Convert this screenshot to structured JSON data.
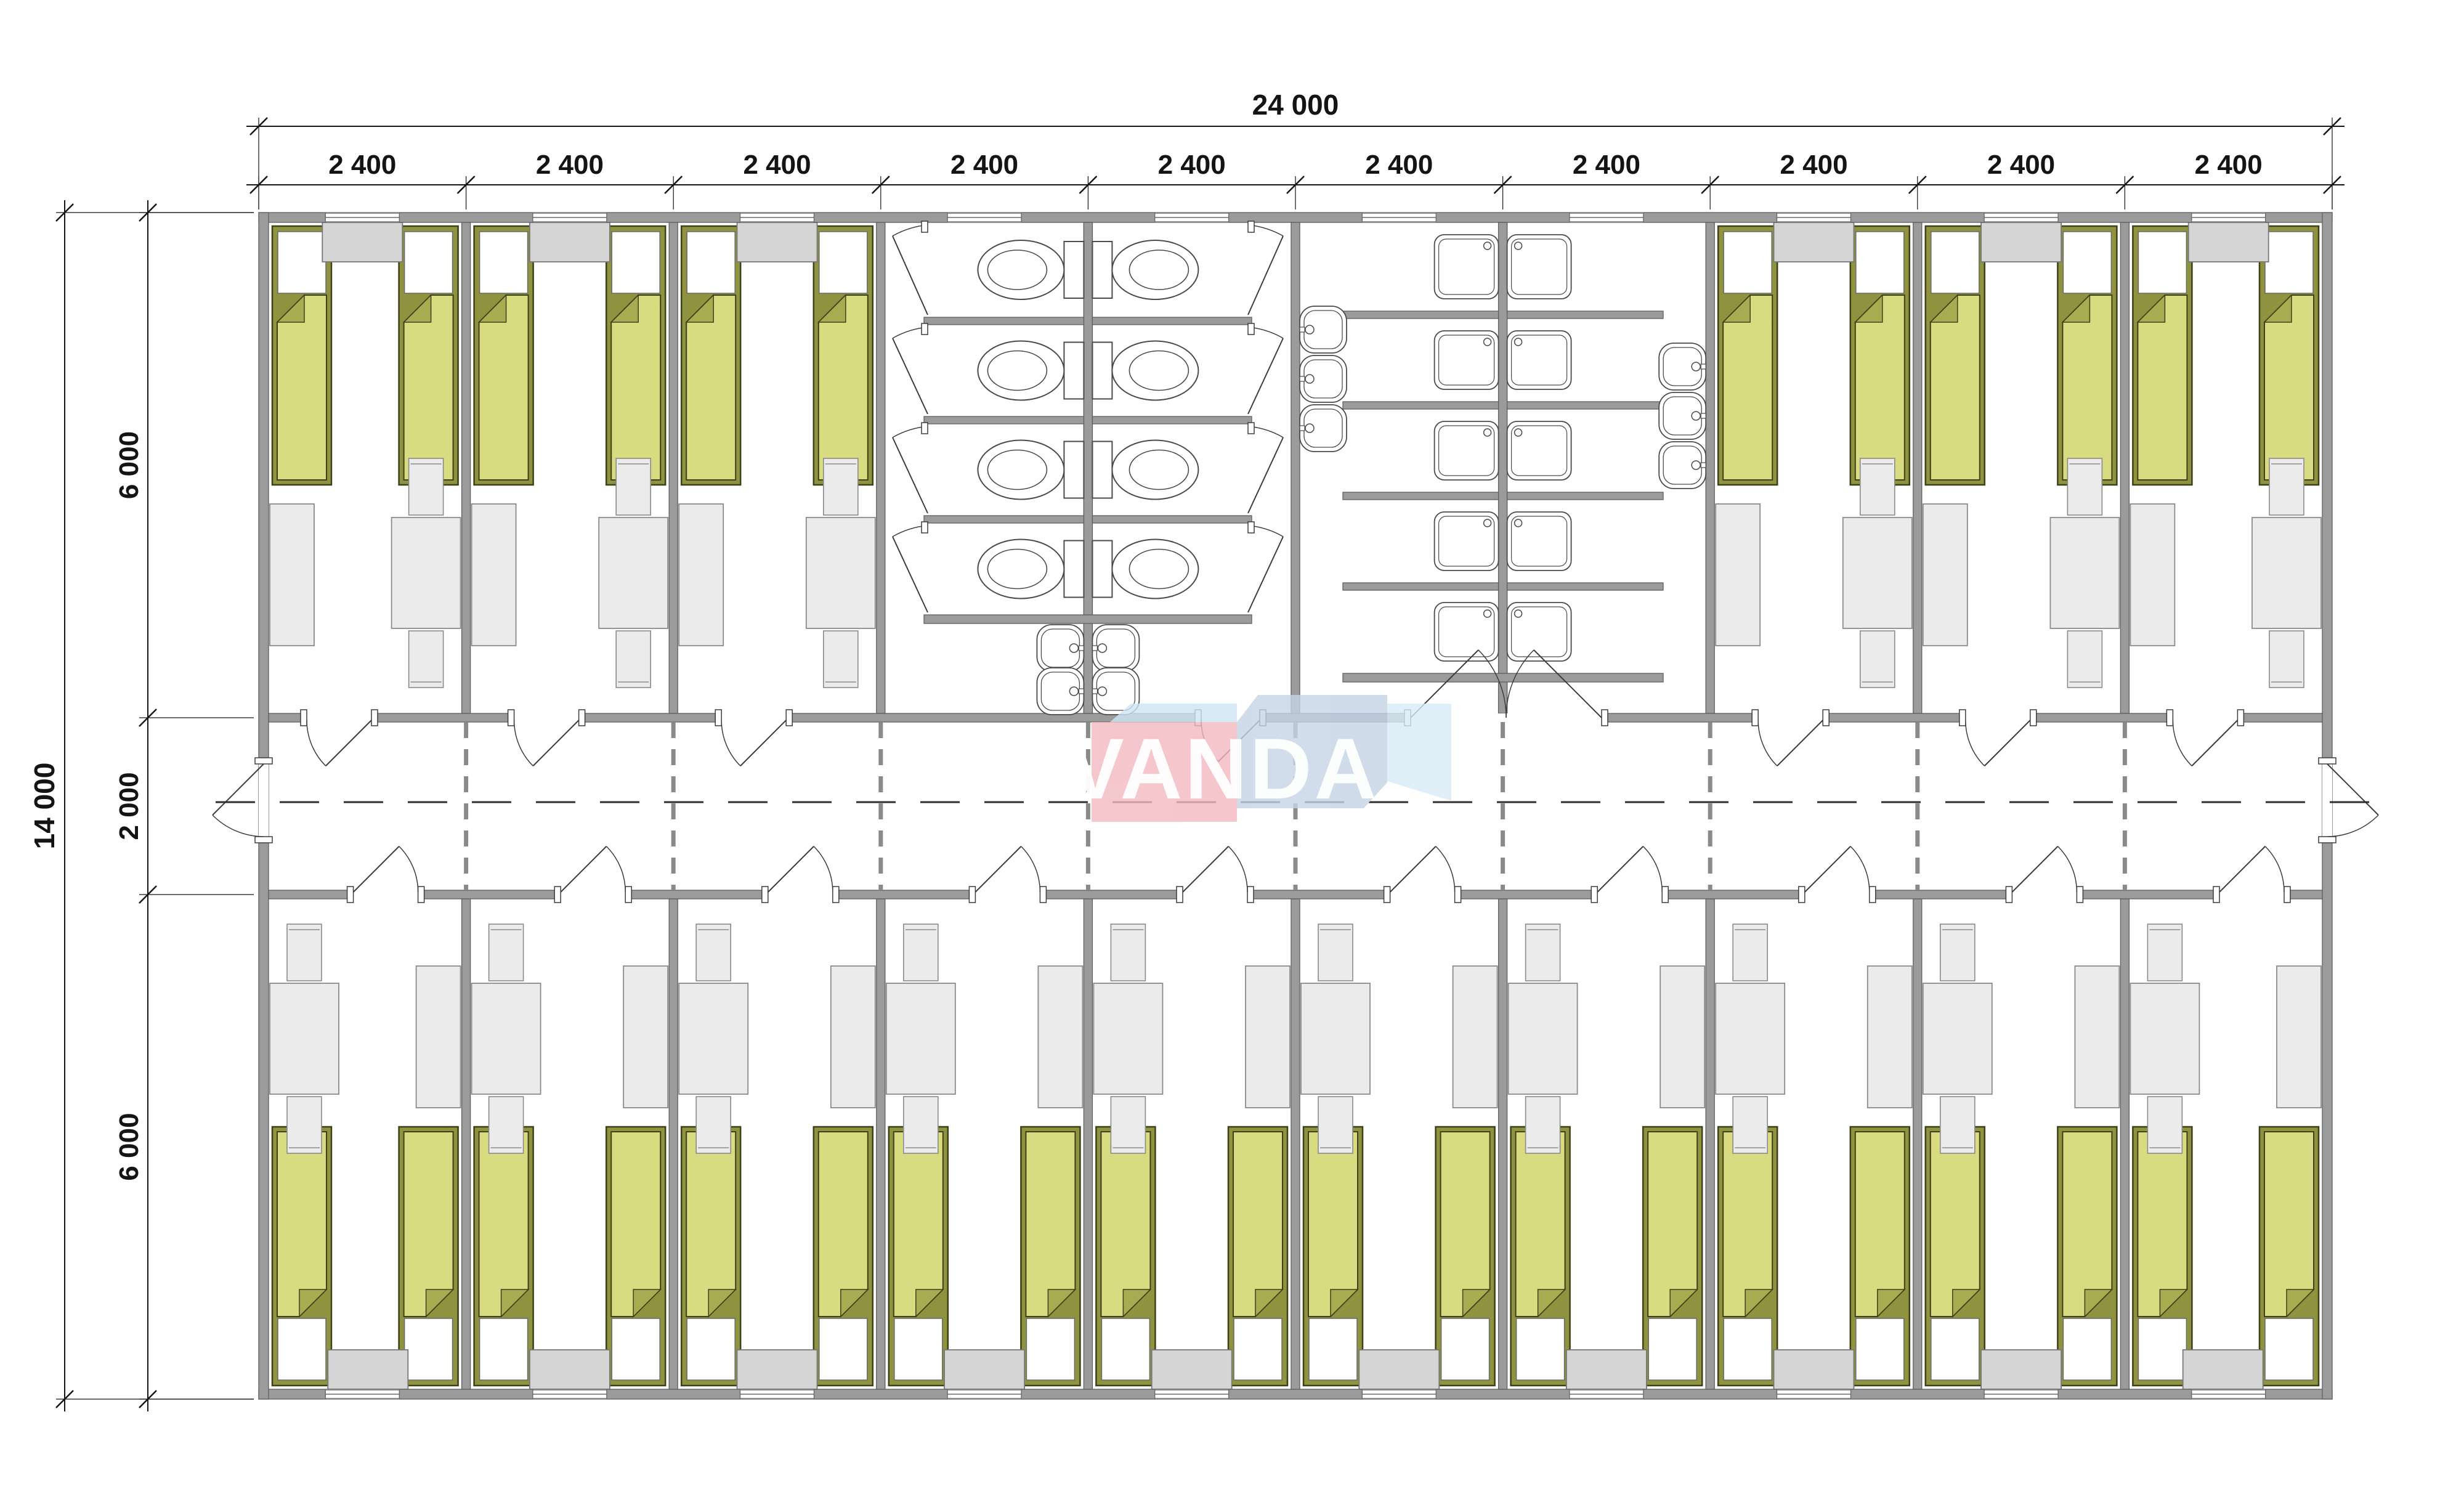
{
  "logo": {
    "text": "VANDA",
    "colors": {
      "pink": "#f3bac1",
      "blue_mid": "#c5d4e6",
      "blue_light": "#cfe6f4",
      "blue_pale": "#d9ebf7",
      "text": "#ffffff"
    }
  },
  "dims": {
    "total_width": "24 000",
    "modules": [
      "2 400",
      "2 400",
      "2 400",
      "2 400",
      "2 400",
      "2 400",
      "2 400",
      "2 400",
      "2 400",
      "2 400"
    ],
    "total_height": "14 000",
    "segments": [
      "6 000",
      "2 000",
      "6 000"
    ]
  },
  "layout": {
    "top_row": [
      "bedroom",
      "bedroom",
      "bedroom",
      "wc",
      "wc",
      "shower",
      "shower",
      "bedroom",
      "bedroom",
      "bedroom"
    ],
    "bottom_row": [
      "bedroom",
      "bedroom",
      "bedroom",
      "bedroom",
      "bedroom",
      "bedroom",
      "bedroom",
      "bedroom",
      "bedroom",
      "bedroom"
    ],
    "corridor": "corridor"
  },
  "room_contents": {
    "bedroom": {
      "beds": 2,
      "wardrobe": 1,
      "dining_table": 1,
      "chairs": 2,
      "desk": 1,
      "door_to_corridor": 1,
      "window": 1
    },
    "wc": {
      "toilet_stalls": 8,
      "washbasins": 4,
      "door_to_corridor": 1
    },
    "shower": {
      "shower_trays": 10,
      "washbasins": 6,
      "double_door_to_corridor": 1
    },
    "corridor": {
      "entrance_doors": 2
    }
  },
  "totals": {
    "beds": 32,
    "toilets": 8,
    "showers": 10,
    "washbasins": 10,
    "tables": 16,
    "desks": 16,
    "chairs": 32,
    "wardrobes": 16
  },
  "colors": {
    "wall": "#9b9b9b",
    "wall_edge": "#5f5f5f",
    "bed_frame": "#8f923e",
    "bed_frame_edge": "#3e401a",
    "bed_blanket": "#d9db80",
    "bed_fold": "#a9ab51",
    "pillow": "#ffffff",
    "cabinet": "#d5d5d5",
    "cabinet_edge": "#787878",
    "furniture": "#ebebeb",
    "furniture_edge": "#8a8a8a",
    "fixture_line": "#4a4a4a",
    "dim": "#141414",
    "dash": "#8a8a8a",
    "door_line": "#3c3c3c"
  }
}
